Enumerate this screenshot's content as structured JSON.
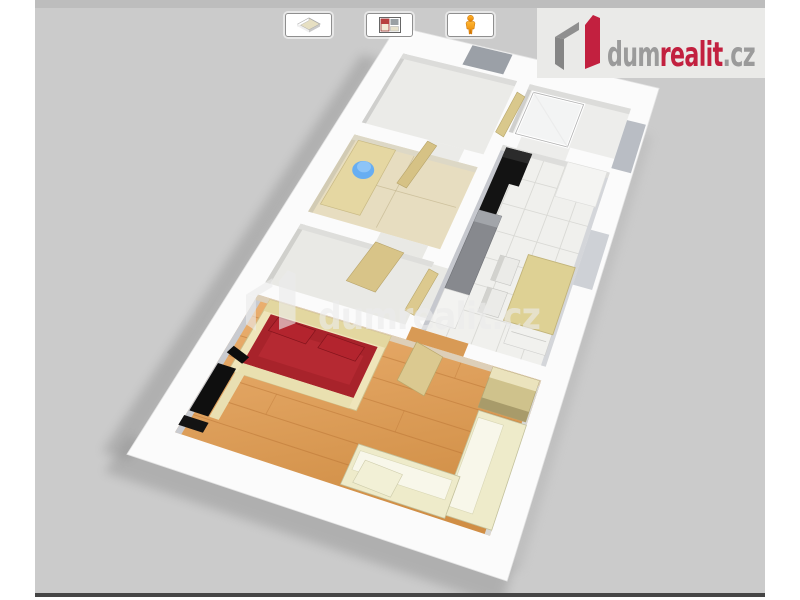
{
  "page": {
    "background": "#ffffff"
  },
  "viewer": {
    "panel_bg": "#cbcbcb",
    "top_band": "#bdbdbd",
    "bottom_bar": "#454545"
  },
  "toolbar": {
    "buttons": [
      {
        "name": "view-3d",
        "icon": "floorplan-3d-icon"
      },
      {
        "name": "view-2d",
        "icon": "floorplan-2d-icon"
      },
      {
        "name": "walkthrough",
        "icon": "person-icon"
      }
    ]
  },
  "logo": {
    "prefix": "dum",
    "accent": "realit",
    "suffix": ".cz",
    "prefix_color": "#9b9b9b",
    "accent_color": "#c2203f",
    "suffix_color": "#9b9b9b"
  },
  "watermark": {
    "text": "dumrealit.cz",
    "color": "#ececec",
    "opacity": 0.62
  },
  "floorplan_palette": {
    "wall": "#fbfbfb",
    "wall_face": "#c6c8ce",
    "wood_floor_light": "#ecb172",
    "wood_floor_dark": "#d08e45",
    "tile_floor": "#f0f0ed",
    "bath_floor": "#e7ddc0",
    "neutral_floor": "#e9e9e5",
    "bed_red": "#a8232b",
    "pillow_red": "#b3242e",
    "bed_frame": "#efe5ba",
    "sofa": "#eeebca",
    "sofa_cushion": "#f8f7ea",
    "door_beige": "#d8c488",
    "wardrobe": "#cfc28c",
    "counter_gray": "#87898e",
    "appliance_black": "#131313",
    "table_beige": "#ded194",
    "sink_blue": "#67aef2",
    "shadow": "#8f8f8f"
  }
}
